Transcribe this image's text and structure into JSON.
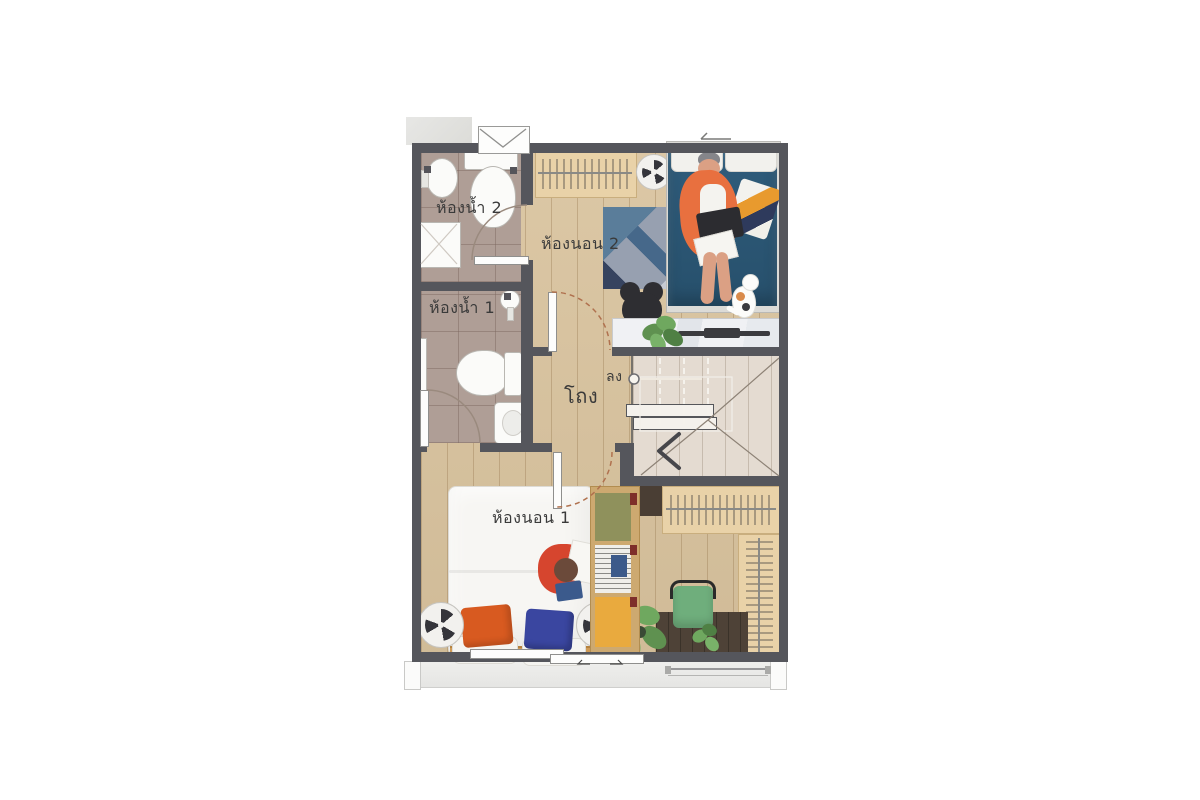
{
  "floor_plan": {
    "type": "residential-second-floor-plan",
    "rooms": [
      {
        "id": "bathroom-2",
        "label": "ห้องน้ำ 2"
      },
      {
        "id": "bathroom-1",
        "label": "ห้องน้ำ 1"
      },
      {
        "id": "bedroom-2",
        "label": "ห้องนอน 2"
      },
      {
        "id": "hall",
        "label": "โถง"
      },
      {
        "id": "bedroom-1",
        "label": "ห้องนอน 1"
      }
    ],
    "stairs": {
      "label": "ลง",
      "direction": "down"
    },
    "colors": {
      "wall": "#55565c",
      "wood_floor": "#d9c39e",
      "bathroom_tile": "#af9e96",
      "stairs_wood": "#e4dbd1",
      "balcony_concrete": "#ebebe9",
      "bed2_blue": "#2d5876",
      "bed1_white": "#f6f5f2",
      "rug_base": "#a0a8b5",
      "rug_orange": "#d9882f",
      "rug_navy": "#36435f",
      "rug_steel_blue": "#5a7d9a",
      "pillow_orange": "#d85a20",
      "pillow_blue": "#3a46a0",
      "rack_wood": "#e9d2a8",
      "desk_walnut": "#4e4237",
      "chair_green": "#6fae7c",
      "plant_green": "#5f9150",
      "marble": "#eef0f2",
      "person_jacket_orange": "#e8703f",
      "person_jacket_red": "#d6452e",
      "label_text": "#3a3a3a"
    }
  }
}
